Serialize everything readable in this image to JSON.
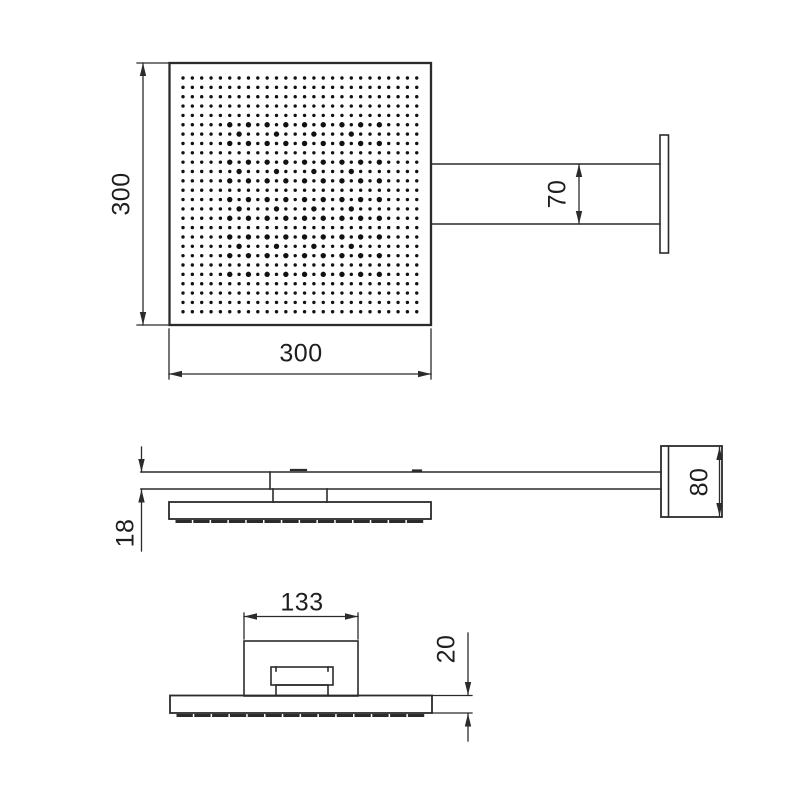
{
  "title": "Square rain shower head with wall arm - dimensioned drawing",
  "colors": {
    "line": "#2b2b2b",
    "text": "#1e1e1e",
    "background": "#ffffff",
    "dot": "#111111"
  },
  "views": {
    "top": {
      "dims": {
        "height": "300",
        "width": "300",
        "arm_width": "70"
      }
    },
    "side": {
      "dims": {
        "arm_thickness": "18",
        "wall_plate": "80"
      }
    },
    "front": {
      "dims": {
        "connector_width": "133",
        "head_thickness": "20"
      }
    }
  }
}
